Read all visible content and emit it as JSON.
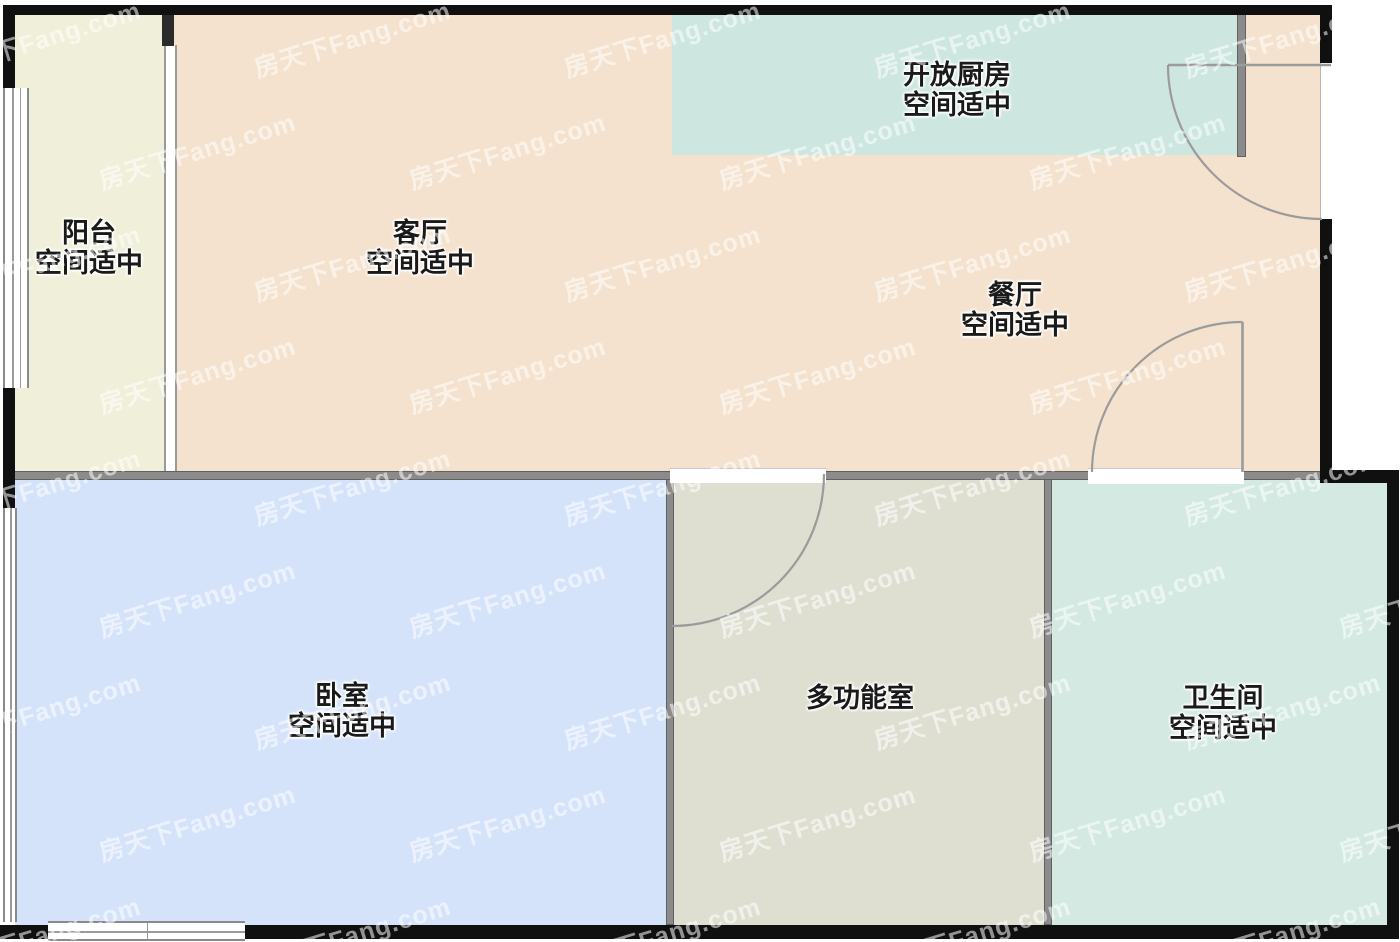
{
  "plan_title": "户型图",
  "watermark": {
    "text": "房天下Fang.com"
  },
  "rooms": {
    "balcony": {
      "name": "阳台",
      "status": "空间适中",
      "color": "#f0efd9"
    },
    "living": {
      "name": "客厅",
      "status": "空间适中",
      "color": "#f4e2ce"
    },
    "kitchen": {
      "name": "开放厨房",
      "status": "空间适中",
      "color": "#cde7e0"
    },
    "dining": {
      "name": "餐厅",
      "status": "空间适中",
      "color": "#f4e2ce"
    },
    "bedroom": {
      "name": "卧室",
      "status": "空间适中",
      "color": "#d5e3fa"
    },
    "multifunction": {
      "name": "多功能室",
      "status": "",
      "color": "#dedfd1"
    },
    "bathroom": {
      "name": "卫生间",
      "status": "空间适中",
      "color": "#d3e9e2"
    }
  },
  "colors": {
    "wall_black": "#101010",
    "wall_gray": "#8b8b8b",
    "door_line": "#9b9b9b",
    "outside": "#ffffff"
  }
}
